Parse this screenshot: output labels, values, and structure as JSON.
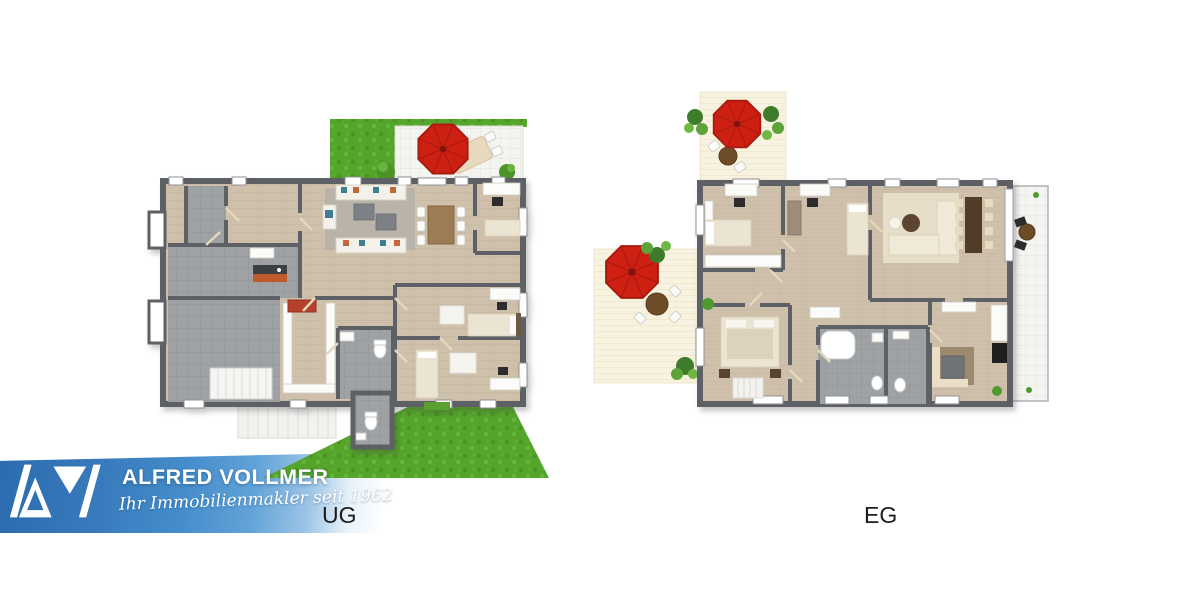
{
  "canvas": {
    "width": 1200,
    "height": 600,
    "background": "#ffffff"
  },
  "floorplans": [
    {
      "id": "ug",
      "label": "UG",
      "type": "basement-floor-plan",
      "features": [
        "garden-lawn",
        "white-tile-terrace",
        "red-parasol",
        "outdoor-dining-set",
        "living-area-sofas",
        "dining-table",
        "desks",
        "gray-tiled-utility-rooms",
        "interior-staircase",
        "exterior-staircase",
        "bathroom",
        "wc",
        "two-bedrooms",
        "lawn-strip-bottom"
      ]
    },
    {
      "id": "eg",
      "label": "EG",
      "type": "ground-floor-plan",
      "features": [
        "terrace-top-with-parasol",
        "terrace-left-with-parasol",
        "potted-plants",
        "two-offices",
        "living-dining-area",
        "balcony-right",
        "double-bedroom",
        "two-bathrooms",
        "kitchen"
      ]
    }
  ],
  "logo_banner": {
    "company": "ALFRED VOLLMER",
    "tagline": "Ihr Immobilienmakler seit 1962",
    "mark_letters": "AV",
    "colors": {
      "blue_dark": "#2a6cae",
      "blue_mid": "#448cca",
      "blue_light": "#60a2d8",
      "text": "#ffffff"
    }
  },
  "labels_color": "#1c1c1e",
  "palette": {
    "wall": "#5d6165",
    "wood_floor": "#cfc0ab",
    "tile_gray": "#9fa2a4",
    "terrace_tile": "#f4f4f0",
    "terrace_cream": "#f8f2e1",
    "grass": "#55a42b",
    "parasol_red": "#cd2013",
    "sofa_teal": "#3f7d92",
    "sofa_orange": "#c2663c"
  }
}
